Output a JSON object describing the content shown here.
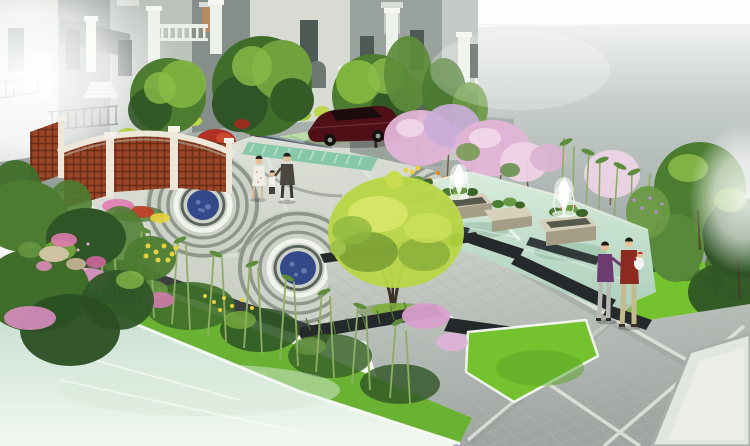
{
  "image": {
    "kind": "landscape-architecture-rendering",
    "width_px": 750,
    "height_px": 446,
    "view": "aerial perspective of residential garden plaza"
  },
  "scene": {
    "background": {
      "buildings": "european style villas with white pillars, balustrades and arched porch",
      "right_wall": "tall misty grey wall fading to white sky",
      "sun_flares": [
        "top-left white glare",
        "right edge white glare"
      ]
    },
    "road": {
      "surface": "grey asphalt lane",
      "parking_strip": "green grasscrete paver strip",
      "car": "dark maroon sedan parked facing left",
      "hedge": "yellow-green trimmed hedge balls",
      "stone_wall": "blue-grey masonry wall"
    },
    "plaza": {
      "paving": "pale grey tile plaza",
      "motif": "three concentric spiral circles with dark-blue mosaic medallions",
      "medallion_count": 3,
      "edge_band": "teal striped paving band",
      "flower_beds": "pink, red, yellow and orange groundcover with tan rocks"
    },
    "water_feature": {
      "pool": "shallow pale-green reflecting pool",
      "planters": "four stone planter boxes with green shrubs",
      "fountains": "two white spray fountains",
      "edging": "dark charcoal stepped granite bands"
    },
    "planting": {
      "trees": "round green street trees, large yellow-green specimen tree, red maple",
      "blossoms": "pink and lavender cherry blossom trees",
      "bamboo": "bamboo screens along bank and behind pool",
      "lawns": "bright green lawn panels with white edge trim"
    },
    "foreground": {
      "water": "milky pale pond across lower-left corner",
      "bank": "grass bank planted with bamboo, pink shrubs and yellow flowers",
      "trellis": "curved white-capped timber lattice screen walls"
    },
    "people": [
      {
        "group": "family-walking",
        "members": [
          "woman in white floral dress",
          "small child",
          "man in dark jacket"
        ],
        "location": "upper plaza"
      },
      {
        "group": "couple-with-baby",
        "members": [
          "man in purple sweater",
          "man in dark red sweater holding baby in white"
        ],
        "location": "right paved terrace"
      }
    ]
  },
  "palette": {
    "sky": "#f7f9f7",
    "wall_top": "#fdfefd",
    "wall_mid": "#c6cdca",
    "wall_low": "#8a9592",
    "building_light": "#cfd4cf",
    "building_mid": "#9aa29d",
    "building_dark": "#858e89",
    "building_white": "#d8dbd4",
    "trim_white": "#eef0ea",
    "window_dark": "#4e5a56",
    "roof_dark": "#5a635f",
    "stone_wall": "#4e5c68",
    "road_light": "#adb4b0",
    "road_dark": "#8f9793",
    "curb": "#e9ede7",
    "grasscrete": "#bcdcab",
    "grasscrete_stripe": "#9cc894",
    "lawn_sliver": "#8cc055",
    "hedge_yellow_green": "#b5d24a",
    "plaza_light": "#dfe2da",
    "plaza_dark": "#c7ccc3",
    "tile_joint": "#e9ece4",
    "ring_dark": "#8e968c",
    "ring_light": "#cdd2c9",
    "mosaic_blue": "#34498a",
    "mosaic_blue_light": "#6e80b4",
    "mosaic_ring_white": "#f1f3ed",
    "mosaic_ring_dark": "#5c645e",
    "teal_band": "#84c6a8",
    "teal_stripe": "#b2dcc8",
    "pool_light": "#d8ecdc",
    "pool_deep": "#accfbc",
    "edging_dark": "#26292b",
    "planter_stone": "#d6d0ba",
    "planter_side": "#a59d85",
    "plant_green": "#4a7c34",
    "fountain_white": "#ffffff",
    "blossom_pink": "#e3b4d6",
    "blossom_lavender": "#c9aed8",
    "blossom_white_pink": "#ecd4e6",
    "tree_dark": "#2f5526",
    "tree_mid": "#4c7c30",
    "tree_light": "#7fb43f",
    "tree_yellow": "#b9d648",
    "tree_yellow_light": "#d9e86a",
    "maple_red": "#b03224",
    "bamboo_stalk": "#8fae62",
    "bamboo_leaf": "#5d8c3a",
    "lawn_bright": "#74c32e",
    "lawn_shade": "#58a426",
    "water_near": "#f2f8f0",
    "water_far": "#c2dcce",
    "trellis_frame": "#ece7d8",
    "trellis_wood": "#9a4526",
    "car_body": "#4e1016",
    "car_window": "#1c0b0d",
    "wheel_dark": "#14100f",
    "skin": "#e8c098",
    "dress_white": "#f0ece6",
    "jacket_dark": "#4a4640",
    "sweater_purple": "#6e3a72",
    "sweater_red": "#8c2a20",
    "pants_light": "#b9bab4",
    "pants_khaki": "#c5b98f",
    "baby_white": "#f2f2ee",
    "flower_red": "#cc3a28",
    "flower_yellow": "#e8d23c",
    "flower_orange": "#e08428",
    "flower_pink": "#e07ab0",
    "rock_tan": "#cfc2a0"
  }
}
